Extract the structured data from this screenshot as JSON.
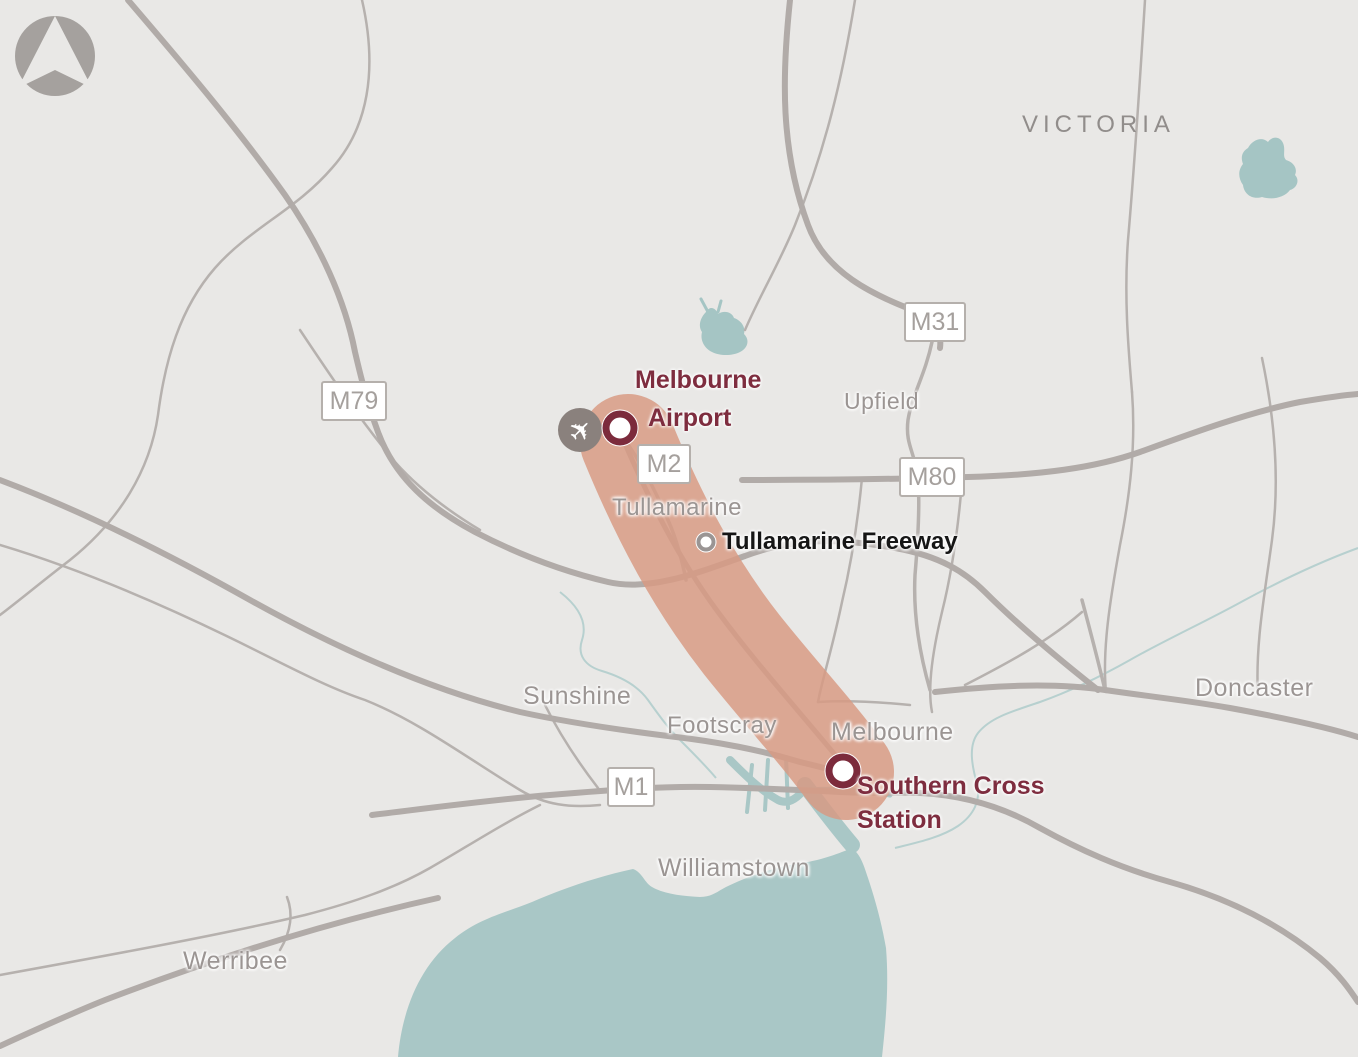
{
  "region": {
    "label": "VICTORIA"
  },
  "places": {
    "tullamarine": "Tullamarine",
    "upfield": "Upfield",
    "sunshine": "Sunshine",
    "footscray": "Footscray",
    "melbourne": "Melbourne",
    "williamstown": "Williamstown",
    "werribee": "Werribee",
    "doncaster": "Doncaster"
  },
  "shields": {
    "m79": "M79",
    "m2": "M2",
    "m31": "M31",
    "m80": "M80",
    "m1": "M1"
  },
  "markers": {
    "airport": {
      "line1": "Melbourne",
      "line2": "Airport"
    },
    "freeway": {
      "label": "Tullamarine Freeway"
    },
    "station": {
      "line1": "Southern Cross",
      "line2": "Station"
    }
  },
  "route": {
    "from": "Melbourne Airport",
    "to": "Southern Cross Station",
    "via": "Tullamarine Freeway"
  },
  "icons": {
    "plane": "✈"
  },
  "colors": {
    "background": "#e9e8e6",
    "road": "#b1aba8",
    "water": "#a9c7c6",
    "river": "#b7d0cf",
    "route_highlight": "#d89a83",
    "marker_ring": "#7c2b3c",
    "label_gray": "#9b9593",
    "label_maroon": "#7e2d3f"
  }
}
